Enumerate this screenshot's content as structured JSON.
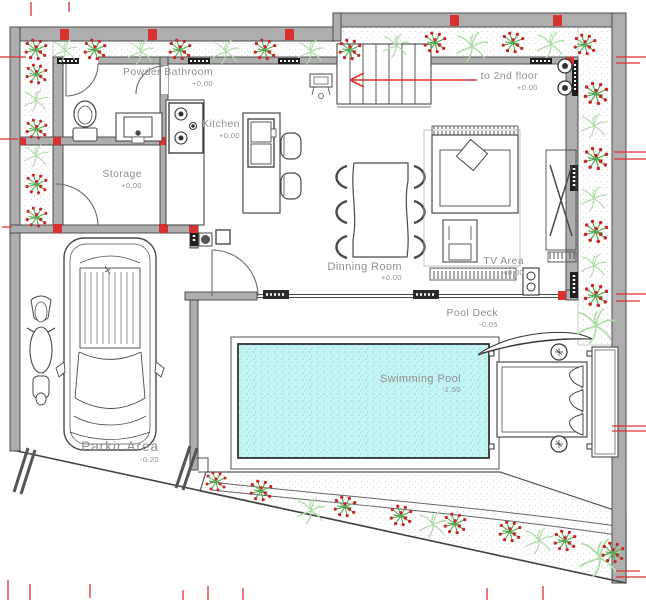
{
  "drawing": {
    "kind": "architectural ground floor plan",
    "rooms": [
      {
        "name": "Powder Bathroom",
        "elevation": "+0.00"
      },
      {
        "name": "Kitchen",
        "elevation": "+0.00"
      },
      {
        "name": "Storage",
        "elevation": "+0.00"
      },
      {
        "name": "to 2nd floor",
        "elevation": "+0.00"
      },
      {
        "name": "Dinning Room",
        "elevation": "+0.00"
      },
      {
        "name": "TV Area",
        "elevation": "+0.00"
      },
      {
        "name": "Pool Deck",
        "elevation": "-0.05"
      },
      {
        "name": "Swimming Pool",
        "elevation": "-1.50"
      },
      {
        "name": "Parkir Area",
        "elevation": "-0.20"
      }
    ],
    "colors": {
      "wall_fill": "#aeaeae",
      "line": "#3f3f3f",
      "accent_red": "#d93030",
      "plant_green": "#57a853",
      "fern_green": "#b2ddab",
      "berry_red": "#c62828",
      "pool_water": "#c7f4f2",
      "label_text": "#8f8f8f"
    }
  }
}
